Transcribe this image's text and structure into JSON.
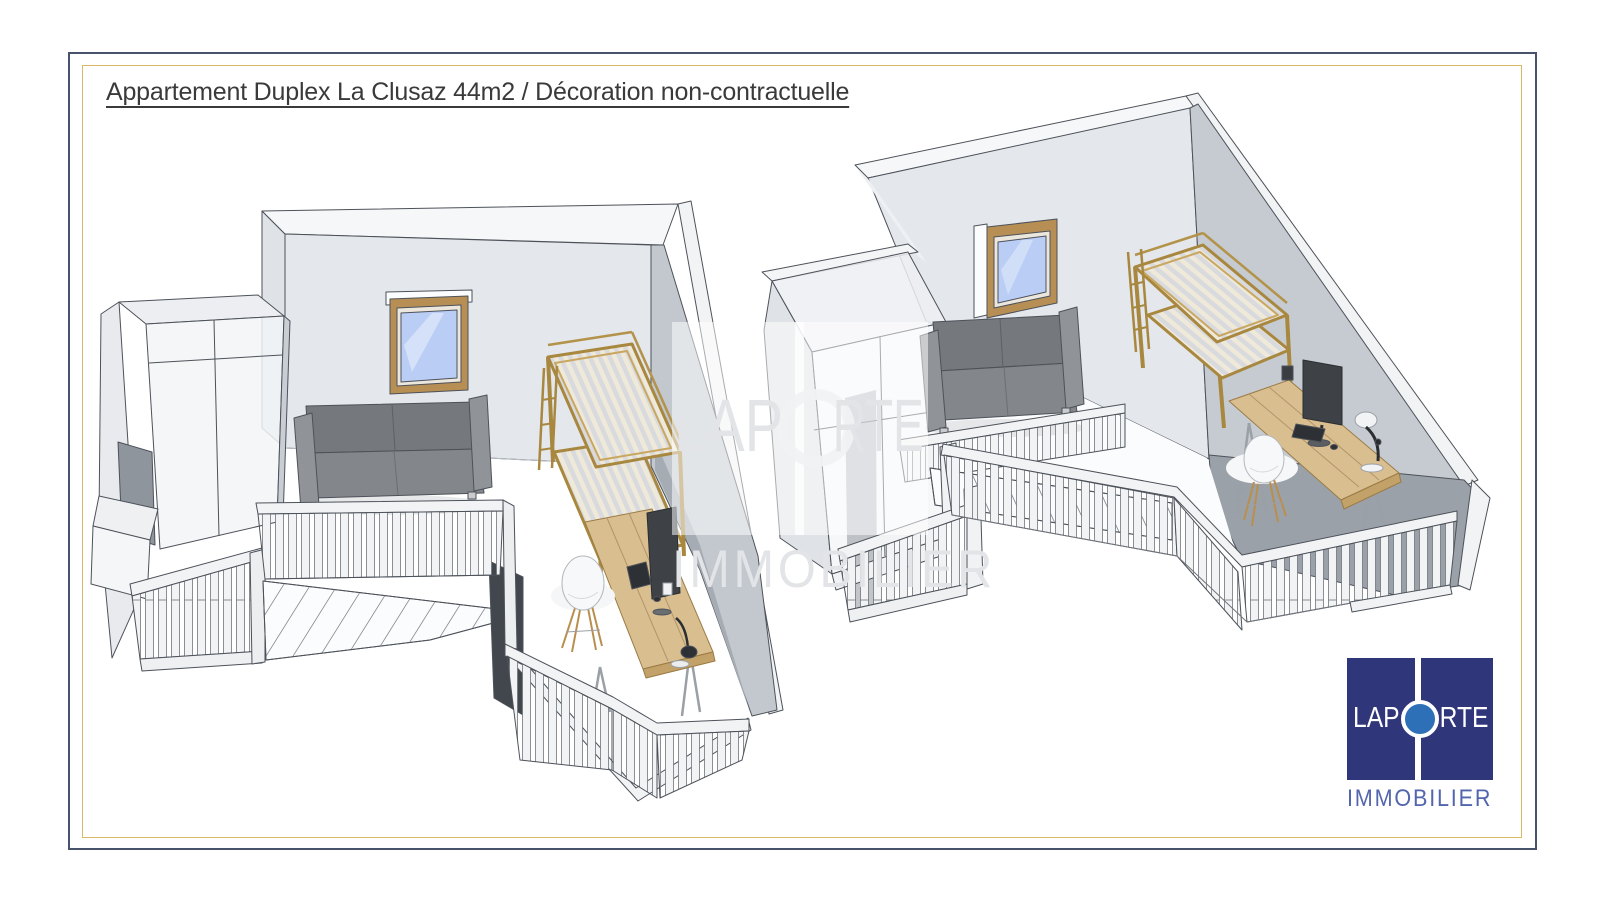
{
  "page": {
    "title": "Appartement Duplex La Clusaz 44m2 / Décoration non-contractuelle"
  },
  "frame": {
    "outer_color": "#47526b",
    "inner_color": "#d9b966"
  },
  "scene": {
    "left_view": {
      "name": "duplex-3d-view-left",
      "furniture": [
        "wardrobe",
        "window",
        "sofa",
        "bunk-bed",
        "desk",
        "monitor",
        "desk-lamp",
        "chair",
        "railing",
        "staircase"
      ]
    },
    "right_view": {
      "name": "duplex-3d-view-right",
      "furniture": [
        "wardrobe",
        "window",
        "sofa",
        "bunk-bed",
        "desk",
        "monitor",
        "desk-lamp",
        "chair",
        "railing",
        "staircase"
      ]
    },
    "colors": {
      "wall": "#e4e7ec",
      "wall_side": "#c6cbd1",
      "wall_dark": "#9ba1a8",
      "wood": "#c9a760",
      "desk_wood": "#d9be90",
      "glass": "#b9cdf5",
      "sofa": "#7d8185"
    }
  },
  "watermark": {
    "text_left": "LAP",
    "text_right": "RTE",
    "line2": "IMMOBILIER"
  },
  "logo": {
    "text_left": "LAP",
    "text_right": "RTE",
    "line2": "IMMOBILIER",
    "square_color": "#30367a",
    "circle_color": "#2d70b7",
    "line2_color": "#5365ad"
  }
}
